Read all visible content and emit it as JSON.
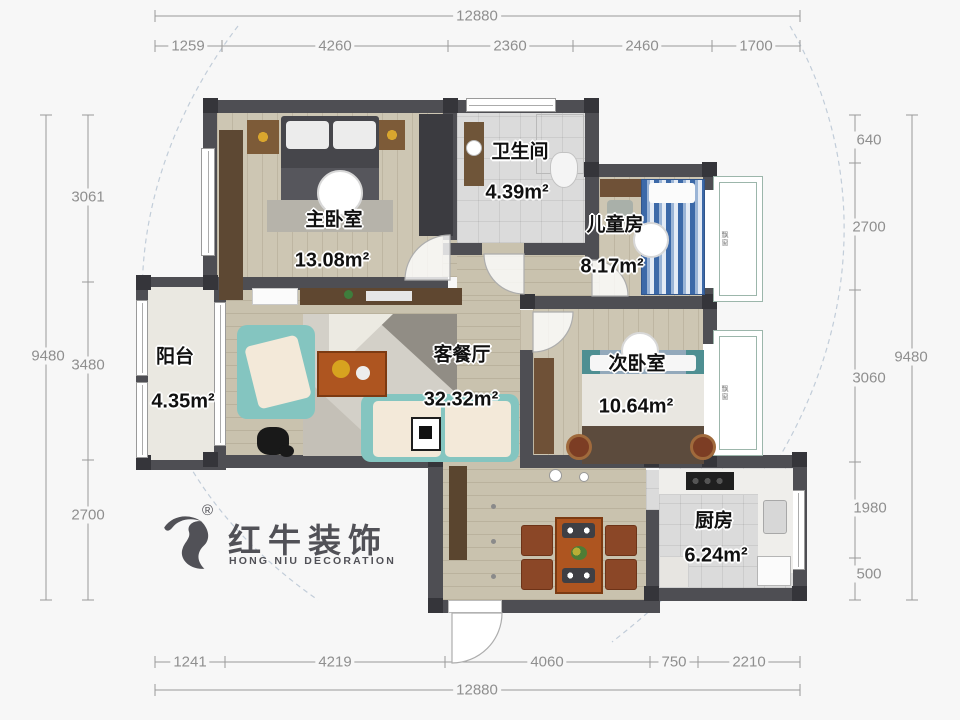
{
  "dimensions": {
    "top": {
      "overall": "12880",
      "segments": [
        "1259",
        "4260",
        "2360",
        "2460",
        "1700"
      ]
    },
    "bottom": {
      "overall": "12880",
      "segments": [
        "1241",
        "4219",
        "4060",
        "750",
        "2210"
      ]
    },
    "left": {
      "overall": "9480",
      "segments": [
        "3061",
        "3480",
        "2700"
      ]
    },
    "right": {
      "overall": "9480",
      "segments": [
        "640",
        "2700",
        "3060",
        "1980",
        "500"
      ]
    }
  },
  "rooms": {
    "master": {
      "name": "主卧室",
      "area": "13.08m²"
    },
    "bath": {
      "name": "卫生间",
      "area": "4.39m²"
    },
    "kids": {
      "name": "儿童房",
      "area": "8.17m²"
    },
    "living": {
      "name": "客餐厅",
      "area": "32.32m²"
    },
    "second": {
      "name": "次卧室",
      "area": "10.64m²"
    },
    "balcony": {
      "name": "阳台",
      "area": "4.35m²"
    },
    "kitchen": {
      "name": "厨房",
      "area": "6.24m²"
    }
  },
  "bays": {
    "top": "飘窗",
    "bottom": "飘窗"
  },
  "logo": {
    "cn": "红牛装饰",
    "en": "HONG NIU DECORATION",
    "reg": "®"
  },
  "colors": {
    "wall": "#4e4e53",
    "wood_floor": "#cdc6b3",
    "sofa_teal": "#84c5c0",
    "table_orange": "#ae5520",
    "kids_bed_blue": "#3c69a8",
    "dim_text": "#8f8f8f"
  }
}
